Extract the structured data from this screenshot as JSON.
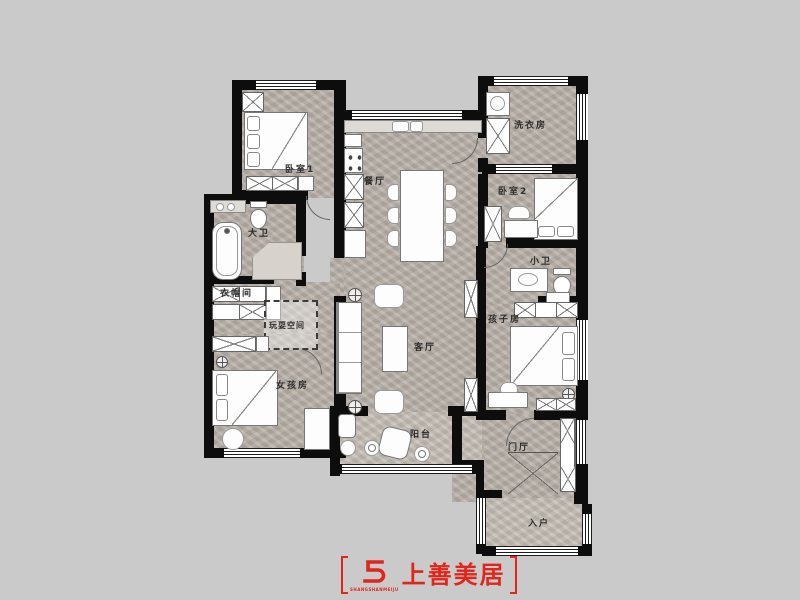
{
  "meta": {
    "type": "residential-floor-plan"
  },
  "theme": {
    "bg": "#cacaca",
    "wall": "#0d0d0d",
    "floor": "#b6afa7",
    "label": "#2e2e2e",
    "accent": "#e0251b"
  },
  "plan": {
    "rooms": {
      "bedroom1": {
        "label": "卧室1"
      },
      "dining": {
        "label": "餐厅"
      },
      "laundry": {
        "label": "洗衣房"
      },
      "bedroom2": {
        "label": "卧室2"
      },
      "main_bath": {
        "label": "大卫"
      },
      "small_bath": {
        "label": "小卫"
      },
      "cloakroom": {
        "label": "衣帽间"
      },
      "play_space": {
        "label": "玩耍空间"
      },
      "living_room": {
        "label": "客厅"
      },
      "girls_room": {
        "label": "女孩房"
      },
      "kids_room": {
        "label": "孩子房"
      },
      "balcony": {
        "label": "阳台"
      },
      "entry_hall": {
        "label": "门厅"
      },
      "foyer": {
        "label": "入户"
      }
    }
  },
  "logo": {
    "brand": "上善美居",
    "monogram": "S5",
    "monogram_subtext": "SHANGSHANMEIJU"
  }
}
